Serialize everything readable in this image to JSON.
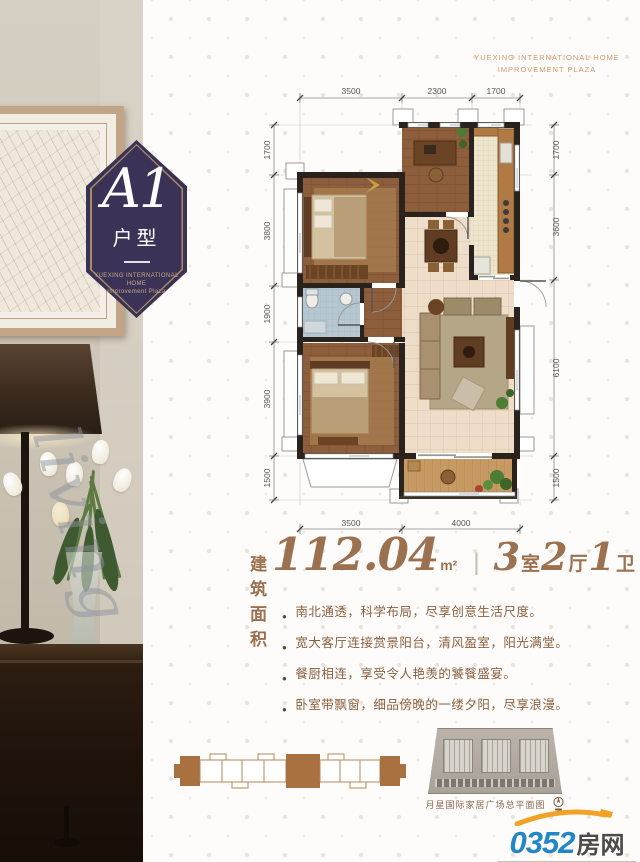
{
  "badge": {
    "code": "A1",
    "type_label": "户型",
    "org_line1": "YUEXING INTERNATIONAL HOME",
    "org_line2": "Improvement Plaza"
  },
  "corner_mark": {
    "line1": "YUEXING INTERNATIONAL HOME",
    "line2": "IMPROVEMENT PLAZA"
  },
  "watermark_script": "living",
  "floor_plan": {
    "dimensions": {
      "top": [
        "3500",
        "2300",
        "1700"
      ],
      "left": [
        "1700",
        "3800",
        "1900",
        "3900",
        "1500"
      ],
      "right": [
        "1700",
        "3600",
        "6100",
        "1500"
      ],
      "bottom": [
        "3500",
        "4000"
      ]
    }
  },
  "area_summary": {
    "label": "建筑面积",
    "value": "112.04",
    "unit": "m²",
    "divider": "|",
    "rooms": "3",
    "rooms_unit": "室",
    "halls": "2",
    "halls_unit": "厅",
    "baths": "1",
    "baths_unit": "卫"
  },
  "features": {
    "bullet_icon": "●",
    "items": [
      "南北通透，科学布局，尽享创意生活尺度。",
      "宽大客厅连接赏景阳台，清风盈室，阳光满堂。",
      "餐厨相连，享受令人艳羡的饕餮盛宴。",
      "卧室带飘窗，细品傍晚的一缕夕阳，尽享浪漫。"
    ]
  },
  "site_plan": {
    "caption": "月星国际家居广场总平面图"
  },
  "logo": {
    "number": "0352",
    "name": "房网",
    "url": "www.0352fang.com"
  },
  "colors": {
    "accent_purple": "#3a3156",
    "badge_gold": "#a8905f",
    "text_brown": "#9b7150",
    "feature_brown": "#8a5f3f",
    "corner_orange": "#d09a6e",
    "logo_blue": "#2386c8",
    "logo_orange": "#f2a229",
    "wall_dark": "#2a221c"
  }
}
